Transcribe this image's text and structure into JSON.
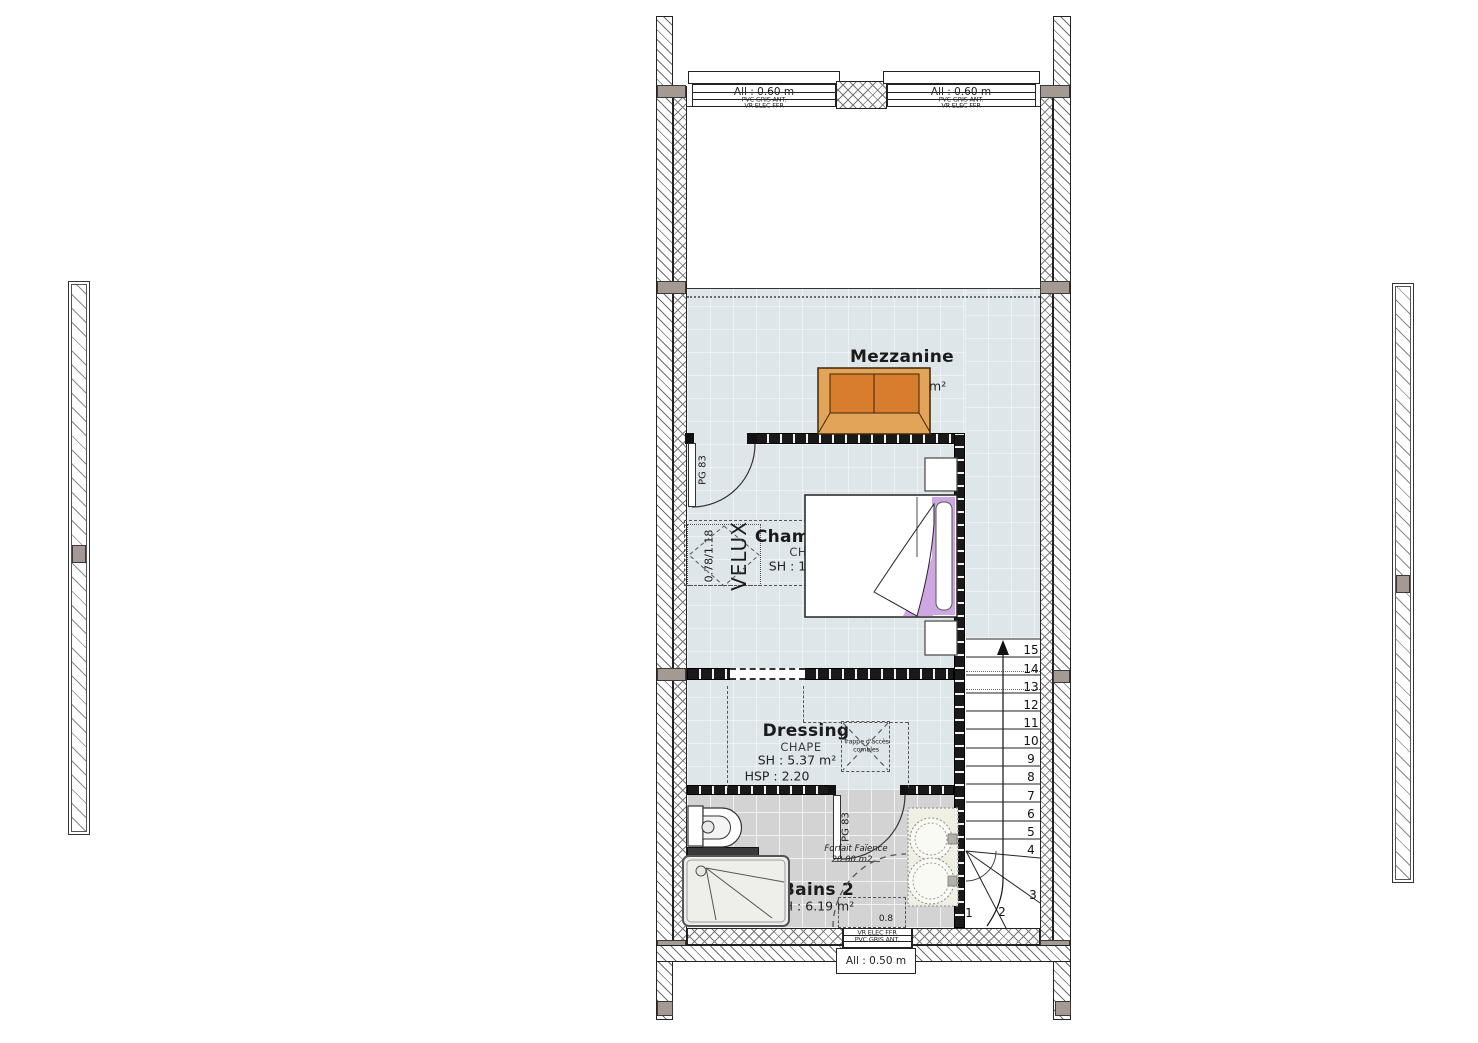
{
  "windows": {
    "top_left": {
      "allege": "All : 0.60 m",
      "material": "PVC GRIS ANT.",
      "shutter": "VR ELEC FFR"
    },
    "top_right": {
      "allege": "All : 0.60 m",
      "material": "PVC GRIS ANT.",
      "shutter": "VR ELEC FFR"
    },
    "bottom": {
      "allege": "All : 0.50 m",
      "material": "PVC GRIS ANT.",
      "shutter": "VR ELEC FFR",
      "leaf_width": "0.8"
    }
  },
  "rooms": {
    "mezzanine": {
      "name": "Mezzanine",
      "finish": "CHAPE",
      "area": "SH : 11.87 m²"
    },
    "chambre1": {
      "name": "Chambre 1",
      "finish": "CHAPE",
      "area": "SH : 10.89 m²",
      "door": "PG 83"
    },
    "dressing": {
      "name": "Dressing",
      "finish": "CHAPE",
      "area": "SH : 5.37 m²",
      "height": "HSP : 2.20",
      "hatch_label_1": "Trappe d'accès",
      "hatch_label_2": "combles"
    },
    "bains2": {
      "name": "Bains 2",
      "area": "SH : 6.19 m²",
      "door": "PG 83",
      "faience_1": "Forfait Faïence",
      "faience_2": "20.00 m2"
    }
  },
  "velux": {
    "label": "VELUX",
    "size": "0.78/1.18"
  },
  "stairs": {
    "steps": [
      "1",
      "2",
      "3",
      "4",
      "5",
      "6",
      "7",
      "8",
      "9",
      "10",
      "11",
      "12",
      "13",
      "14",
      "15"
    ]
  },
  "colors": {
    "floor": "#dfe6ea",
    "bath_floor": "#d3d3d3",
    "sofa_frame": "#e2a458",
    "sofa_seat": "#d87c2e",
    "bed_accent": "#cda6e2",
    "counter": "#f0efe3"
  }
}
